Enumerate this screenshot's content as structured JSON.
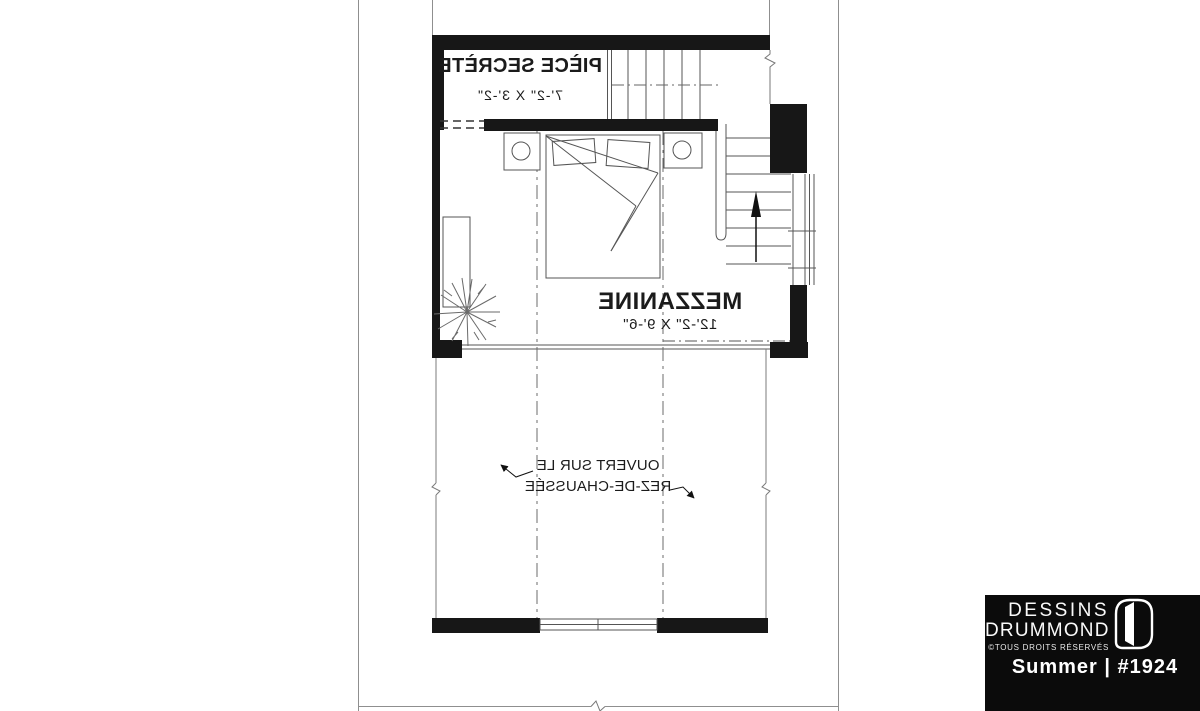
{
  "colors": {
    "background": "#ffffff",
    "wall_fill": "#171717",
    "line": "#4d4d4d",
    "thin_line": "#8f8f8f",
    "brand_plate_bg": "#0b0b0b",
    "brand_text": "#ffffff"
  },
  "plan": {
    "secret_room": {
      "name": "PIÈCE SECRÈTE",
      "dims": "7'-2\" X 3'-2\""
    },
    "mezzanine": {
      "name": "MEZZANINE",
      "dims": "12'-2\" X 9'-6\""
    },
    "open_below": {
      "line1": "OUVERT SUR LE",
      "line2": "REZ-DE-CHAUSSÉE"
    }
  },
  "branding": {
    "name_line1": "DESSINS",
    "name_line2": "DRUMMOND",
    "rights": "©TOUS DROITS RÉSERVÉS",
    "plan_title": "Summer | #1924"
  }
}
